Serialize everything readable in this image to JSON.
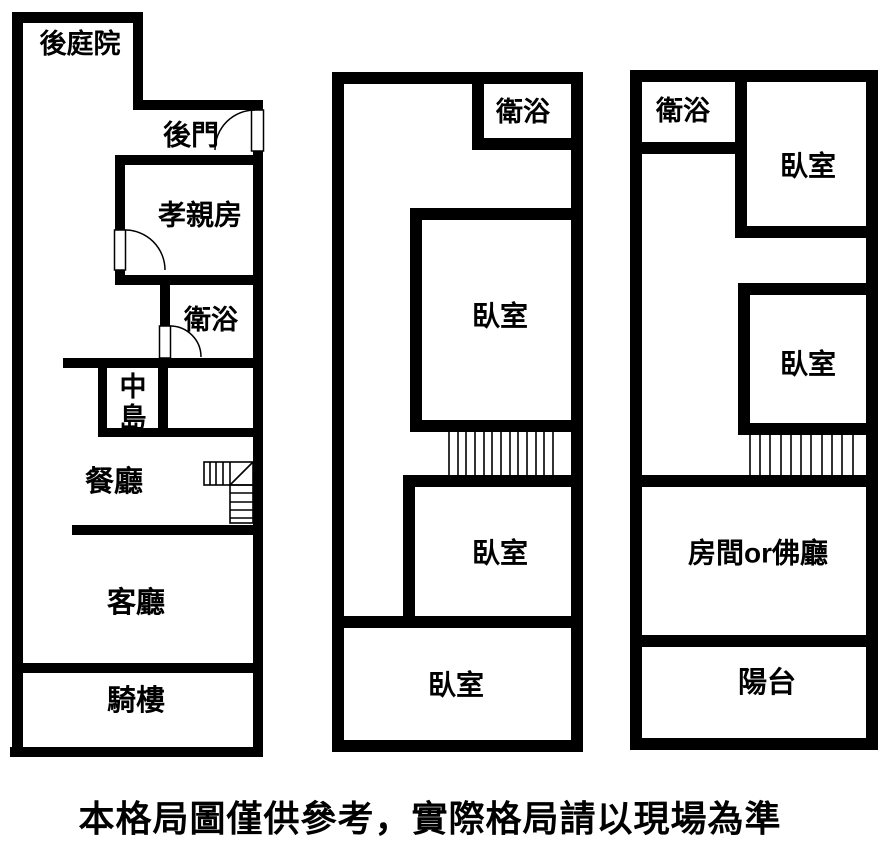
{
  "colors": {
    "wall": "#000000",
    "background": "#ffffff"
  },
  "caption": "本格局圖僅供參考，實際格局請以現場為準",
  "plans": [
    {
      "id": "floor-1",
      "features": [
        "back-door-swing",
        "elder-room-door-swing",
        "bathroom-door-swing",
        "winder-staircase"
      ],
      "rooms": [
        {
          "label": "後庭院"
        },
        {
          "label": "後門"
        },
        {
          "label": "孝親房"
        },
        {
          "label": "衛浴"
        },
        {
          "label": "中島"
        },
        {
          "label": "餐廳"
        },
        {
          "label": "客廳"
        },
        {
          "label": "騎樓"
        }
      ]
    },
    {
      "id": "floor-2",
      "features": [
        "straight-staircase"
      ],
      "rooms": [
        {
          "label": "衛浴"
        },
        {
          "label": "臥室"
        },
        {
          "label": "臥室"
        },
        {
          "label": "臥室"
        }
      ]
    },
    {
      "id": "floor-3",
      "features": [
        "straight-staircase"
      ],
      "rooms": [
        {
          "label": "衛浴"
        },
        {
          "label": "臥室"
        },
        {
          "label": "臥室"
        },
        {
          "label": "房間or佛廳"
        },
        {
          "label": "陽台"
        }
      ]
    }
  ]
}
